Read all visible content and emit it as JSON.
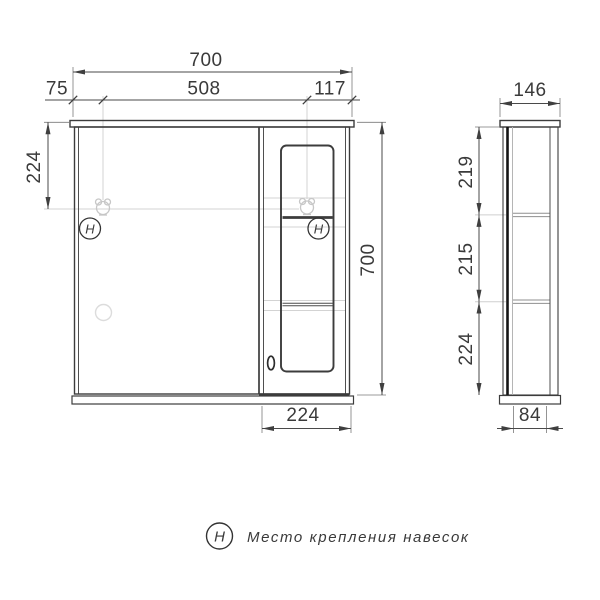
{
  "front_view": {
    "dims": {
      "total_width": "700",
      "hanger_span": "508",
      "hanger_offset_left": "75",
      "hanger_offset_right": "117",
      "hanger_offset_top": "224",
      "total_height": "700",
      "door_section_width": "224"
    },
    "hanger_symbol": "H"
  },
  "side_view": {
    "dims": {
      "total_depth": "146",
      "upper_section": "219",
      "middle_section": "215",
      "lower_section": "224",
      "body_depth": "84"
    }
  },
  "legend": {
    "symbol": "H",
    "text": "Место крепления навесок"
  },
  "colors": {
    "main_line": "#3c3c3c",
    "dim_line": "#555555",
    "faint_line": "#cccccc",
    "background": "#ffffff"
  }
}
